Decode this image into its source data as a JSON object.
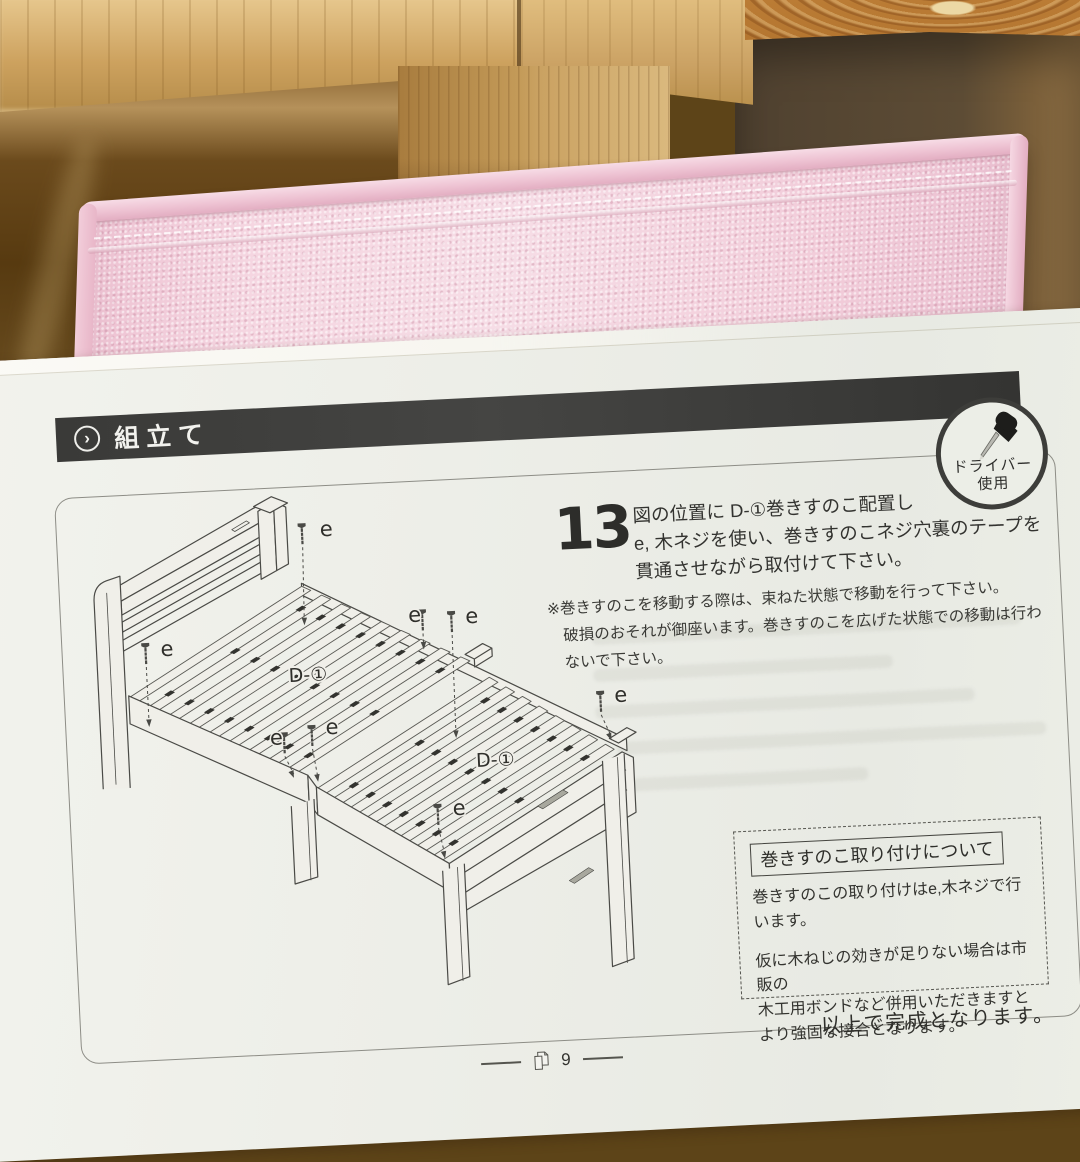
{
  "colors": {
    "header_bar": "#3a3a38",
    "paper": "#edeee8",
    "pink_fabric": "#f2cbd9",
    "line_art": "#4a4a46"
  },
  "scene": {
    "background": "wooden furniture and pink fabric box behind paper manual on floor"
  },
  "page": {
    "header": {
      "title": "組立て"
    },
    "tool_badge": {
      "line1": "ドライバー",
      "line2": "使用"
    },
    "step": {
      "number": "13",
      "line1": "図の位置に D-①巻きすのこ配置し",
      "line2": "e, 木ネジを使い、巻きすのこネジ穴裏のテープを",
      "line3": "貫通させながら取付けて下さい。"
    },
    "note": {
      "line1": "※巻きすのこを移動する際は、束ねた状態で移動を行って下さい。",
      "line2": "破損のおそれが御座います。巻きすのこを広げた状態での移動は行わないで下さい。"
    },
    "info_box": {
      "title": "巻きすのこ取り付けについて",
      "body1": "巻きすのこの取り付けはe,木ネジで行います。",
      "body2_line1": "仮に木ねじの効きが足りない場合は市販の",
      "body2_line2": "木工用ボンドなど併用いただきますと",
      "body2_line3": "より強固な接合となります。"
    },
    "completion": "以上で完成となります。",
    "footer": {
      "page_number": "9"
    }
  },
  "diagram": {
    "screw_label": "e",
    "part_label": "D-①",
    "part_label_positions": [
      [
        245,
        202
      ],
      [
        428,
        296
      ]
    ],
    "spacer_rows": [
      0.1,
      0.48,
      0.86
    ],
    "width_vec": [
      178,
      -103
    ],
    "halves": [
      {
        "o": [
          65,
          210
        ],
        "L": [
          175,
          88
        ],
        "n": 9
      },
      {
        "o": [
          248,
          310
        ],
        "L": [
          129,
          83
        ],
        "n": 8
      }
    ],
    "screws": [
      {
        "x": 246,
        "y": 46,
        "ax": 244,
        "ay": 146,
        "lx": 264,
        "ly": 58
      },
      {
        "x": 84,
        "y": 158,
        "ax": 84,
        "ay": 240,
        "lx": 99,
        "ly": 170
      },
      {
        "x": 362,
        "y": 138,
        "ax": 362,
        "ay": 176,
        "lx": 348,
        "ly": 148
      },
      {
        "x": 391,
        "y": 141,
        "ax": 390,
        "ay": 266,
        "lx": 405,
        "ly": 152
      },
      {
        "x": 536,
        "y": 228,
        "ax": 545,
        "ay": 276,
        "lx": 550,
        "ly": 238
      },
      {
        "x": 218,
        "y": 254,
        "ax": 226,
        "ay": 298,
        "lx": 204,
        "ly": 264
      },
      {
        "x": 246,
        "y": 248,
        "ax": 250,
        "ay": 303,
        "lx": 260,
        "ly": 256
      },
      {
        "x": 368,
        "y": 333,
        "ax": 373,
        "ay": 386,
        "lx": 383,
        "ly": 343
      }
    ]
  }
}
